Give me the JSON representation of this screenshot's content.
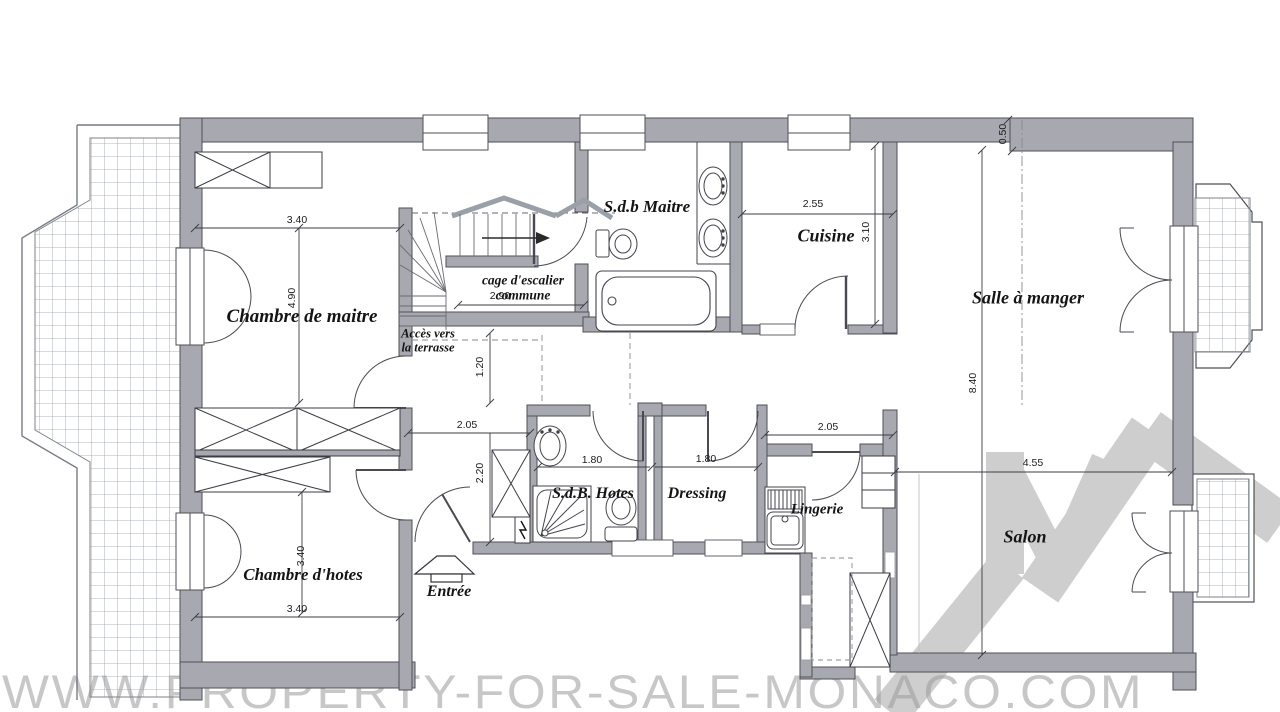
{
  "rooms": {
    "master_bedroom": "Chambre de maitre",
    "master_bath": "S.d.b Maitre",
    "stairwell": "cage d'escalier commune",
    "terrace_access": "Accès vers la terrasse",
    "kitchen": "Cuisine",
    "dining_room": "Salle à manger",
    "guest_bath": "S.d.B. Hotes",
    "dressing": "Dressing",
    "laundry": "Lingerie",
    "guest_bedroom": "Chambre d'hotes",
    "entrance": "Entrée",
    "living_room": "Salon"
  },
  "dimensions": {
    "master_width": "3.40",
    "master_depth": "4.90",
    "stair_width": "2.90",
    "hall_depth": "1.20",
    "hall_width": "2.05",
    "hall_height": "2.20",
    "guest_bath_width": "1.80",
    "dressing_width": "1.80",
    "laundry_width": "2.05",
    "kitchen_width": "2.55",
    "kitchen_depth": "3.10",
    "wall_offset": "0.50",
    "living_depth": "8.40",
    "salon_width": "4.55",
    "guest_bedroom_depth": "3.40",
    "guest_bedroom_width": "3.40"
  },
  "watermark": {
    "url_text": "WWW.PROPERTY-FOR-SALE-MONACO.COM"
  },
  "colors": {
    "wall_fill": "#a8a8b0",
    "watermark_gray": "#9e9e9e",
    "watermark_text_gray": "#c7c7c7"
  }
}
